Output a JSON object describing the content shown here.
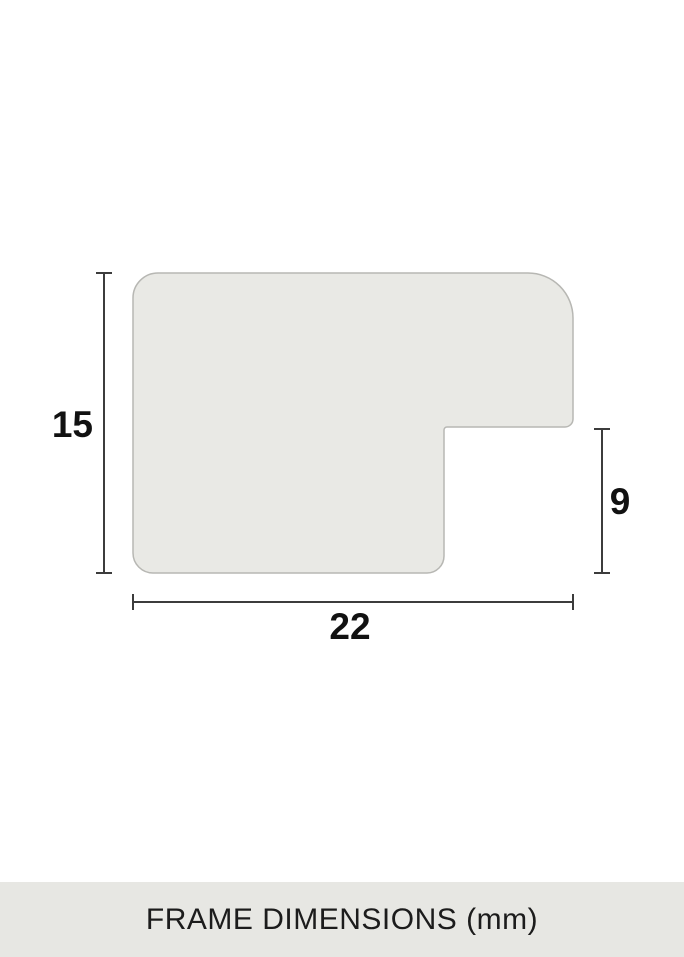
{
  "diagram": {
    "caption": "FRAME DIMENSIONS (mm)",
    "unit": "mm",
    "dimensions": {
      "profile_height": "15",
      "profile_width": "22",
      "rabbet_depth": "9"
    },
    "colors": {
      "background": "#ffffff",
      "profile_fill": "#e9e9e5",
      "profile_stroke": "#b7b7b3",
      "dimension_line": "#3c3c3c",
      "label_text": "#111111",
      "caption_band": "#e7e7e3",
      "caption_text": "#1c1c1c"
    }
  }
}
